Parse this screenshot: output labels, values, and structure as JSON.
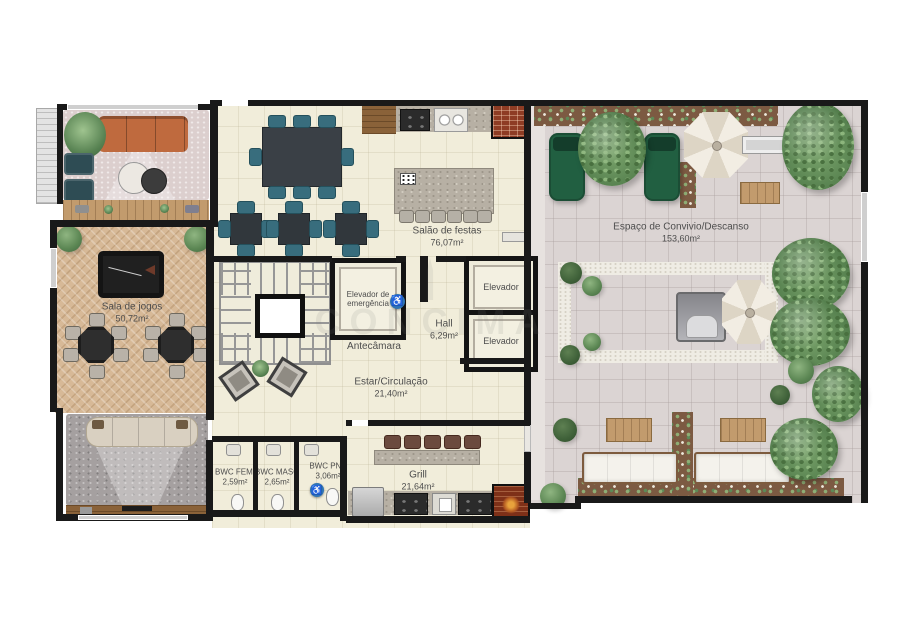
{
  "plan": {
    "watermark": "CONCIMA",
    "icons": {
      "wheelchair": "♿"
    },
    "rooms": {
      "sala_jogos": {
        "name": "Sala de jogos",
        "area": "50,72m²"
      },
      "salao_festas": {
        "name": "Salão de festas",
        "area": "76,07m²"
      },
      "elevador_emergencia": {
        "name": "Elevador de emergência"
      },
      "antecamara": {
        "name": "Antecâmara"
      },
      "hall": {
        "name": "Hall",
        "area": "6,29m²"
      },
      "elevador_1": {
        "name": "Elevador"
      },
      "elevador_2": {
        "name": "Elevador"
      },
      "estar_circulacao": {
        "name": "Estar/Circulação",
        "area": "21,40m²"
      },
      "bwc_fem": {
        "name": "BWC FEM.",
        "area": "2,59m²"
      },
      "bwc_masc": {
        "name": "BWC MASC",
        "area": "2,65m²"
      },
      "bwc_pne": {
        "name": "BWC PNE",
        "area": "3,06m²"
      },
      "grill": {
        "name": "Grill",
        "area": "21,64m²"
      },
      "espaco_convivio": {
        "name": "Espaço de Convivio/Descanso",
        "area": "153,60m²"
      }
    },
    "colors": {
      "wall": "#191919",
      "floor_interior": "#f1edda",
      "floor_wood": "#d7b997",
      "terrace": "#dbd4d3",
      "accent_blue": "#2f74b5",
      "chair_teal": "#386d7d",
      "sofa_orange": "#bf6a3e",
      "chaise_green": "#215f41",
      "brick": "#8e3c24"
    }
  }
}
